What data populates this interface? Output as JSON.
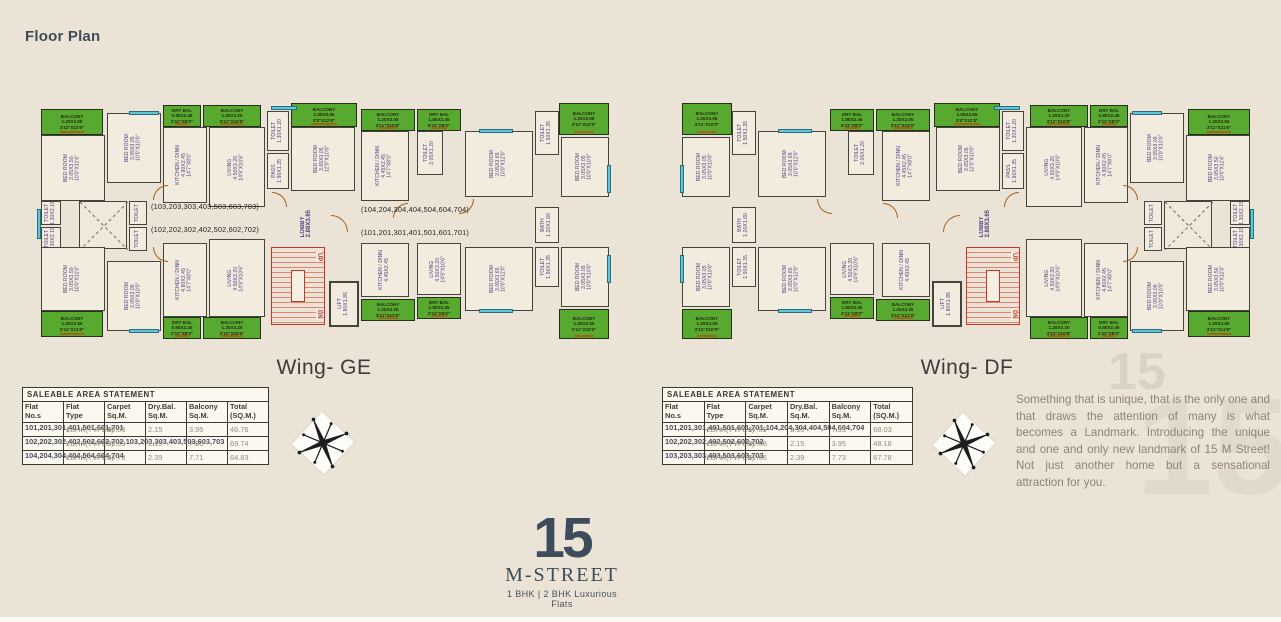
{
  "page": {
    "title": "Floor Plan",
    "background": "#ebe4d6"
  },
  "colors": {
    "balcony_green": "#57a92f",
    "window_cyan": "#5ec7d9",
    "door_orange": "#a9601c",
    "stairs_red": "#c0392b",
    "room_label_purple": "#514083",
    "logo_slate": "#3d4c5a",
    "paragraph_brown": "#8f8373"
  },
  "wings": [
    {
      "id": "ge",
      "name": "Wing- GE",
      "mirrored": false,
      "annotations": [
        {
          "text": "(103,203,303,403,503,603,703)",
          "x": 116,
          "y": 105
        },
        {
          "text": "(102,202,302,402,502,602,702)",
          "x": 116,
          "y": 128
        },
        {
          "text": "(104,204,304,404,504,604,704)",
          "x": 326,
          "y": 108
        },
        {
          "text": "(101,201,301,401,501,601,701)",
          "x": 326,
          "y": 131
        }
      ],
      "table": {
        "title": "SALEABLE AREA STATEMENT",
        "columns": [
          "Flat No.s",
          "Flat Type",
          "Carpet Sq.M.",
          "Dry.Bal. Sq.M.",
          "Balcony Sq.M.",
          "Total (SQ.M.)"
        ],
        "rows": [
          {
            "flats": "101,201,301,401,501,601,701",
            "type": "1BHK(TYPE2)",
            "carpet": "40.66",
            "drybal": "2.15",
            "balcony": "3.95",
            "total": "46.76"
          },
          {
            "flats": "102,202,302,402,502,602,702,103,203,303,403,503,603,703",
            "type": "2BHK(TYPE3)",
            "carpet": "59.69",
            "drybal": "2.15",
            "balcony": "7.90",
            "total": "69.74"
          },
          {
            "flats": "104,204,304,404,504,604,704",
            "type": "2BHK(TYPE4)",
            "carpet": "54.73",
            "drybal": "2.39",
            "balcony": "7.71",
            "total": "64.83"
          }
        ]
      }
    },
    {
      "id": "df",
      "name": "Wing- DF",
      "mirrored": true,
      "annotations": [],
      "table": {
        "title": "SALEABLE AREA STATEMENT",
        "columns": [
          "Flat No.s",
          "Flat Type",
          "Carpet Sq.M.",
          "Dry.Bal. Sq.M.",
          "Balcony Sq.M.",
          "Total (SQ.M.)"
        ],
        "rows": [
          {
            "flats": "101,201,301,401,501,601,701,104,204,304,404,504,604,704",
            "type": "2BHK(TYPE1)",
            "carpet": "57.89",
            "drybal": "2.15",
            "balcony": "7.99",
            "total": "68.03"
          },
          {
            "flats": "102,202,302,402,502,602,702",
            "type": "1BHK(TYPE1)",
            "carpet": "42.08",
            "drybal": "2.15",
            "balcony": "3.95",
            "total": "48.18"
          },
          {
            "flats": "103,203,303,403,503,603,703",
            "type": "2BHK(TYPE2)",
            "carpet": "57.66",
            "drybal": "2.39",
            "balcony": "7.73",
            "total": "67.78"
          }
        ]
      }
    }
  ],
  "plan_elements": [
    {
      "kind": "balcony",
      "x": 6,
      "y": 12,
      "w": 62,
      "h": 26,
      "label": [
        "BALCONY",
        "1.20X3.50",
        "3'11\"X11'6\""
      ]
    },
    {
      "kind": "room",
      "x": 6,
      "y": 38,
      "w": 64,
      "h": 66,
      "label": [
        "BED ROOM",
        "3.05X3.50",
        "10'0\"X11'6\""
      ]
    },
    {
      "kind": "room",
      "x": 72,
      "y": 16,
      "w": 54,
      "h": 70,
      "label": [
        "BED ROOM",
        "3.05X3.05",
        "10'0\"X10'0\""
      ]
    },
    {
      "kind": "balcony",
      "x": 128,
      "y": 8,
      "w": 38,
      "h": 22,
      "label": [
        "DRY BAL",
        "0.90X2.45",
        "2'11\"X8'0\""
      ]
    },
    {
      "kind": "room",
      "x": 128,
      "y": 30,
      "w": 44,
      "h": 76,
      "label": [
        "KITCHEN / DINN",
        "4.80X2.45",
        "14'7\"X8'0\""
      ]
    },
    {
      "kind": "balcony",
      "x": 168,
      "y": 8,
      "w": 58,
      "h": 22,
      "label": [
        "BALCONY",
        "1.20X3.20",
        "3'11\"X10'6\""
      ]
    },
    {
      "kind": "room",
      "x": 174,
      "y": 30,
      "w": 56,
      "h": 80,
      "label": [
        "LIVING",
        "4.50X3.20",
        "14'9\"X10'6\""
      ]
    },
    {
      "kind": "room",
      "x": 232,
      "y": 14,
      "w": 22,
      "h": 40,
      "label": [
        "TOILET",
        "1.30X1.20"
      ]
    },
    {
      "kind": "room",
      "x": 232,
      "y": 56,
      "w": 22,
      "h": 36,
      "label": [
        "PASS",
        "1.90X1.35"
      ]
    },
    {
      "kind": "balcony",
      "x": 256,
      "y": 6,
      "w": 66,
      "h": 24,
      "label": [
        "BALCONY",
        "1.05X3.65",
        "3'5\"X12'0\""
      ]
    },
    {
      "kind": "room",
      "x": 256,
      "y": 30,
      "w": 64,
      "h": 64,
      "label": [
        "BED ROOM",
        "3.65X3.05",
        "12'0\"X10'0\""
      ]
    },
    {
      "kind": "balcony",
      "x": 326,
      "y": 12,
      "w": 54,
      "h": 22,
      "label": [
        "BALCONY",
        "1.20X3.05",
        "3'11\"X10'0\""
      ]
    },
    {
      "kind": "room",
      "x": 326,
      "y": 34,
      "w": 48,
      "h": 70,
      "label": [
        "KITCHEN / DINN",
        "4.45X2.45",
        "14'7\"X8'0\""
      ]
    },
    {
      "kind": "balcony",
      "x": 382,
      "y": 12,
      "w": 44,
      "h": 22,
      "label": [
        "DRY BAL",
        "1.80X2.45",
        "5'11\"X8'0\""
      ]
    },
    {
      "kind": "room",
      "x": 382,
      "y": 34,
      "w": 26,
      "h": 44,
      "label": [
        "TOILET",
        "2.05X1.20"
      ]
    },
    {
      "kind": "room",
      "x": 430,
      "y": 34,
      "w": 68,
      "h": 66,
      "label": [
        "BED ROOM",
        "3.05X3.65",
        "10'0\"X12'0\""
      ]
    },
    {
      "kind": "room",
      "x": 500,
      "y": 14,
      "w": 24,
      "h": 44,
      "label": [
        "TOILET",
        "1.50X1.35"
      ]
    },
    {
      "kind": "balcony",
      "x": 524,
      "y": 6,
      "w": 50,
      "h": 32,
      "label": [
        "BALCONY",
        "1.20X3.05",
        "3'11\"X10'0\""
      ]
    },
    {
      "kind": "room",
      "x": 526,
      "y": 40,
      "w": 48,
      "h": 60,
      "label": [
        "BED ROOM",
        "3.05X3.05",
        "10'0\"X10'0\""
      ]
    },
    {
      "kind": "shaft",
      "x": 44,
      "y": 104,
      "w": 48,
      "h": 48
    },
    {
      "kind": "room",
      "x": 6,
      "y": 104,
      "w": 20,
      "h": 24,
      "label": [
        "TOILET",
        "1.30X2.15"
      ]
    },
    {
      "kind": "room",
      "x": 6,
      "y": 130,
      "w": 20,
      "h": 24,
      "label": [
        "TOILET",
        "1.30X2.15"
      ]
    },
    {
      "kind": "room",
      "x": 94,
      "y": 104,
      "w": 18,
      "h": 24,
      "label": [
        "TOILET"
      ]
    },
    {
      "kind": "room",
      "x": 94,
      "y": 130,
      "w": 18,
      "h": 24,
      "label": [
        "TOILET"
      ]
    },
    {
      "kind": "lobby",
      "x": 258,
      "y": 96,
      "w": 26,
      "h": 62,
      "label": [
        "LOBBY",
        "2.88X3.65"
      ]
    },
    {
      "kind": "room",
      "x": 500,
      "y": 110,
      "w": 24,
      "h": 36,
      "label": [
        "BATH",
        "1.20X1.60"
      ]
    },
    {
      "kind": "room",
      "x": 6,
      "y": 150,
      "w": 64,
      "h": 64,
      "label": [
        "BED ROOM",
        "3.05X3.50",
        "10'0\"X11'6\""
      ]
    },
    {
      "kind": "balcony",
      "x": 6,
      "y": 214,
      "w": 62,
      "h": 26,
      "label": [
        "BALCONY",
        "1.20X3.50",
        "3'11\"X11'6\""
      ]
    },
    {
      "kind": "room",
      "x": 72,
      "y": 164,
      "w": 54,
      "h": 70,
      "label": [
        "BED ROOM",
        "3.05X3.05",
        "10'0\"X10'0\""
      ]
    },
    {
      "kind": "room",
      "x": 128,
      "y": 146,
      "w": 44,
      "h": 74,
      "label": [
        "KITCHEN / DINN",
        "4.80X2.45",
        "14'7\"X8'0\""
      ]
    },
    {
      "kind": "balcony",
      "x": 128,
      "y": 220,
      "w": 38,
      "h": 22,
      "label": [
        "DRY BAL",
        "0.90X2.45",
        "2'11\"X8'0\""
      ]
    },
    {
      "kind": "room",
      "x": 174,
      "y": 142,
      "w": 56,
      "h": 78,
      "label": [
        "LIVING",
        "4.50X3.20",
        "14'9\"X10'6\""
      ]
    },
    {
      "kind": "balcony",
      "x": 168,
      "y": 220,
      "w": 58,
      "h": 22,
      "label": [
        "BALCONY",
        "1.20X3.20",
        "3'11\"X10'6\""
      ]
    },
    {
      "kind": "stairs",
      "x": 236,
      "y": 150,
      "w": 54,
      "h": 78,
      "up": "UP",
      "dn": "DN"
    },
    {
      "kind": "room",
      "x": 294,
      "y": 184,
      "w": 30,
      "h": 46,
      "label": [
        "LIFT",
        "1.80X1.85"
      ],
      "dark": true
    },
    {
      "kind": "room",
      "x": 326,
      "y": 146,
      "w": 48,
      "h": 54,
      "label": [
        "KITCHEN / DINN",
        "4.45X2.45"
      ]
    },
    {
      "kind": "balcony",
      "x": 326,
      "y": 202,
      "w": 54,
      "h": 22,
      "label": [
        "BALCONY",
        "1.20X3.35",
        "3'11\"X11'0\""
      ]
    },
    {
      "kind": "room",
      "x": 382,
      "y": 146,
      "w": 44,
      "h": 52,
      "label": [
        "LIVING",
        "4.50X3.20",
        "14'9\"X10'6\""
      ]
    },
    {
      "kind": "balcony",
      "x": 382,
      "y": 200,
      "w": 44,
      "h": 22,
      "label": [
        "DRY BAL",
        "1.80X2.45",
        "2'11\"X8'0\""
      ]
    },
    {
      "kind": "room",
      "x": 430,
      "y": 150,
      "w": 68,
      "h": 64,
      "label": [
        "BED ROOM",
        "3.05X3.65",
        "10'0\"X12'0\""
      ]
    },
    {
      "kind": "room",
      "x": 500,
      "y": 150,
      "w": 24,
      "h": 40,
      "label": [
        "TOILET",
        "1.50X1.35"
      ]
    },
    {
      "kind": "balcony",
      "x": 524,
      "y": 212,
      "w": 50,
      "h": 30,
      "label": [
        "BALCONY",
        "1.20X3.05",
        "3'11\"X10'0\""
      ]
    },
    {
      "kind": "room",
      "x": 526,
      "y": 150,
      "w": 48,
      "h": 60,
      "label": [
        "BED ROOM",
        "3.05X3.05",
        "10'0\"X10'0\""
      ]
    },
    {
      "kind": "window",
      "x": 94,
      "y": 14,
      "w": 30,
      "h": 4
    },
    {
      "kind": "window",
      "x": 236,
      "y": 9,
      "w": 26,
      "h": 4
    },
    {
      "kind": "window",
      "x": 444,
      "y": 32,
      "w": 34,
      "h": 4
    },
    {
      "kind": "window",
      "x": 94,
      "y": 232,
      "w": 30,
      "h": 4
    },
    {
      "kind": "window",
      "x": 444,
      "y": 212,
      "w": 34,
      "h": 4
    },
    {
      "kind": "window",
      "x": 2,
      "y": 112,
      "w": 4,
      "h": 30
    },
    {
      "kind": "window",
      "x": 572,
      "y": 68,
      "w": 4,
      "h": 28
    },
    {
      "kind": "window",
      "x": 572,
      "y": 158,
      "w": 4,
      "h": 28
    },
    {
      "kind": "door",
      "x": 118,
      "y": 88,
      "w": 15,
      "h": 15,
      "rot": 0
    },
    {
      "kind": "door",
      "x": 237,
      "y": 95,
      "w": 15,
      "h": 15,
      "rot": 90
    },
    {
      "kind": "door",
      "x": 358,
      "y": 106,
      "w": 15,
      "h": 15,
      "rot": 0
    },
    {
      "kind": "door",
      "x": 424,
      "y": 102,
      "w": 15,
      "h": 15,
      "rot": 180
    },
    {
      "kind": "door",
      "x": 118,
      "y": 150,
      "w": 15,
      "h": 15,
      "rot": 270
    },
    {
      "kind": "door",
      "x": 296,
      "y": 118,
      "w": 17,
      "h": 17,
      "rot": 90
    }
  ],
  "description": "Something that is unique, that is the only one and that draws the attention of many is what becomes a Landmark. Introducing the unique and one and only new landmark of 15 M Street! Not just another home but a sensational attraction for you.",
  "watermark": "15",
  "logo": {
    "big": "15",
    "name": "M-STREET",
    "tagline": "1 BHK | 2 BHK Luxurious Flats"
  },
  "compass_label": "compass-rose"
}
